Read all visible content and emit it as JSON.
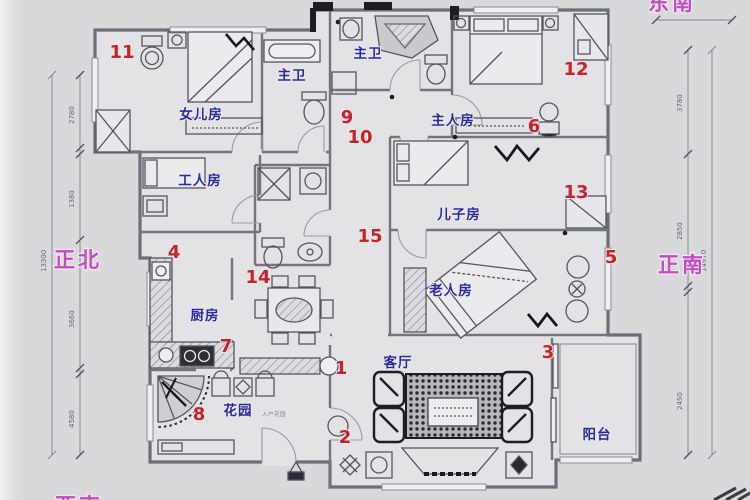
{
  "title": "apartment-floor-plan",
  "colors": {
    "paper": "#d9d8db",
    "interior": "#e3e2e5",
    "wall_gray": "#6e6e78",
    "wall_black": "#1c1c22",
    "room_label_blue": "#2b2b9e",
    "marker_red": "#c2242c",
    "direction_pink": "#c24cc0"
  },
  "direction_labels": {
    "left": "正北",
    "right": "正南",
    "top_right": "东南",
    "bottom_left": "西南"
  },
  "room_labels": {
    "daughter": "女儿房",
    "bath_left": "主卫",
    "bath_center": "主卫",
    "master": "主人房",
    "worker": "工人房",
    "son": "儿子房",
    "elder": "老人房",
    "kitchen": "厨房",
    "living": "客厅",
    "garden": "花园",
    "balcony": "阳台",
    "entry_note": "入户花园"
  },
  "markers": {
    "m1": "1",
    "m2": "2",
    "m3": "3",
    "m4": "4",
    "m5": "5",
    "m6": "6",
    "m7": "7",
    "m8": "8",
    "m9": "9",
    "m10": "10",
    "m11": "11",
    "m12": "12",
    "m13": "13",
    "m14": "14",
    "m15": "15"
  },
  "dimensions": {
    "left_total": "13300",
    "left_segments": [
      "2780",
      "1380",
      "3660",
      "4580"
    ],
    "right_total": "14970",
    "right_segments": [
      "3780",
      "2850",
      "2450"
    ]
  }
}
